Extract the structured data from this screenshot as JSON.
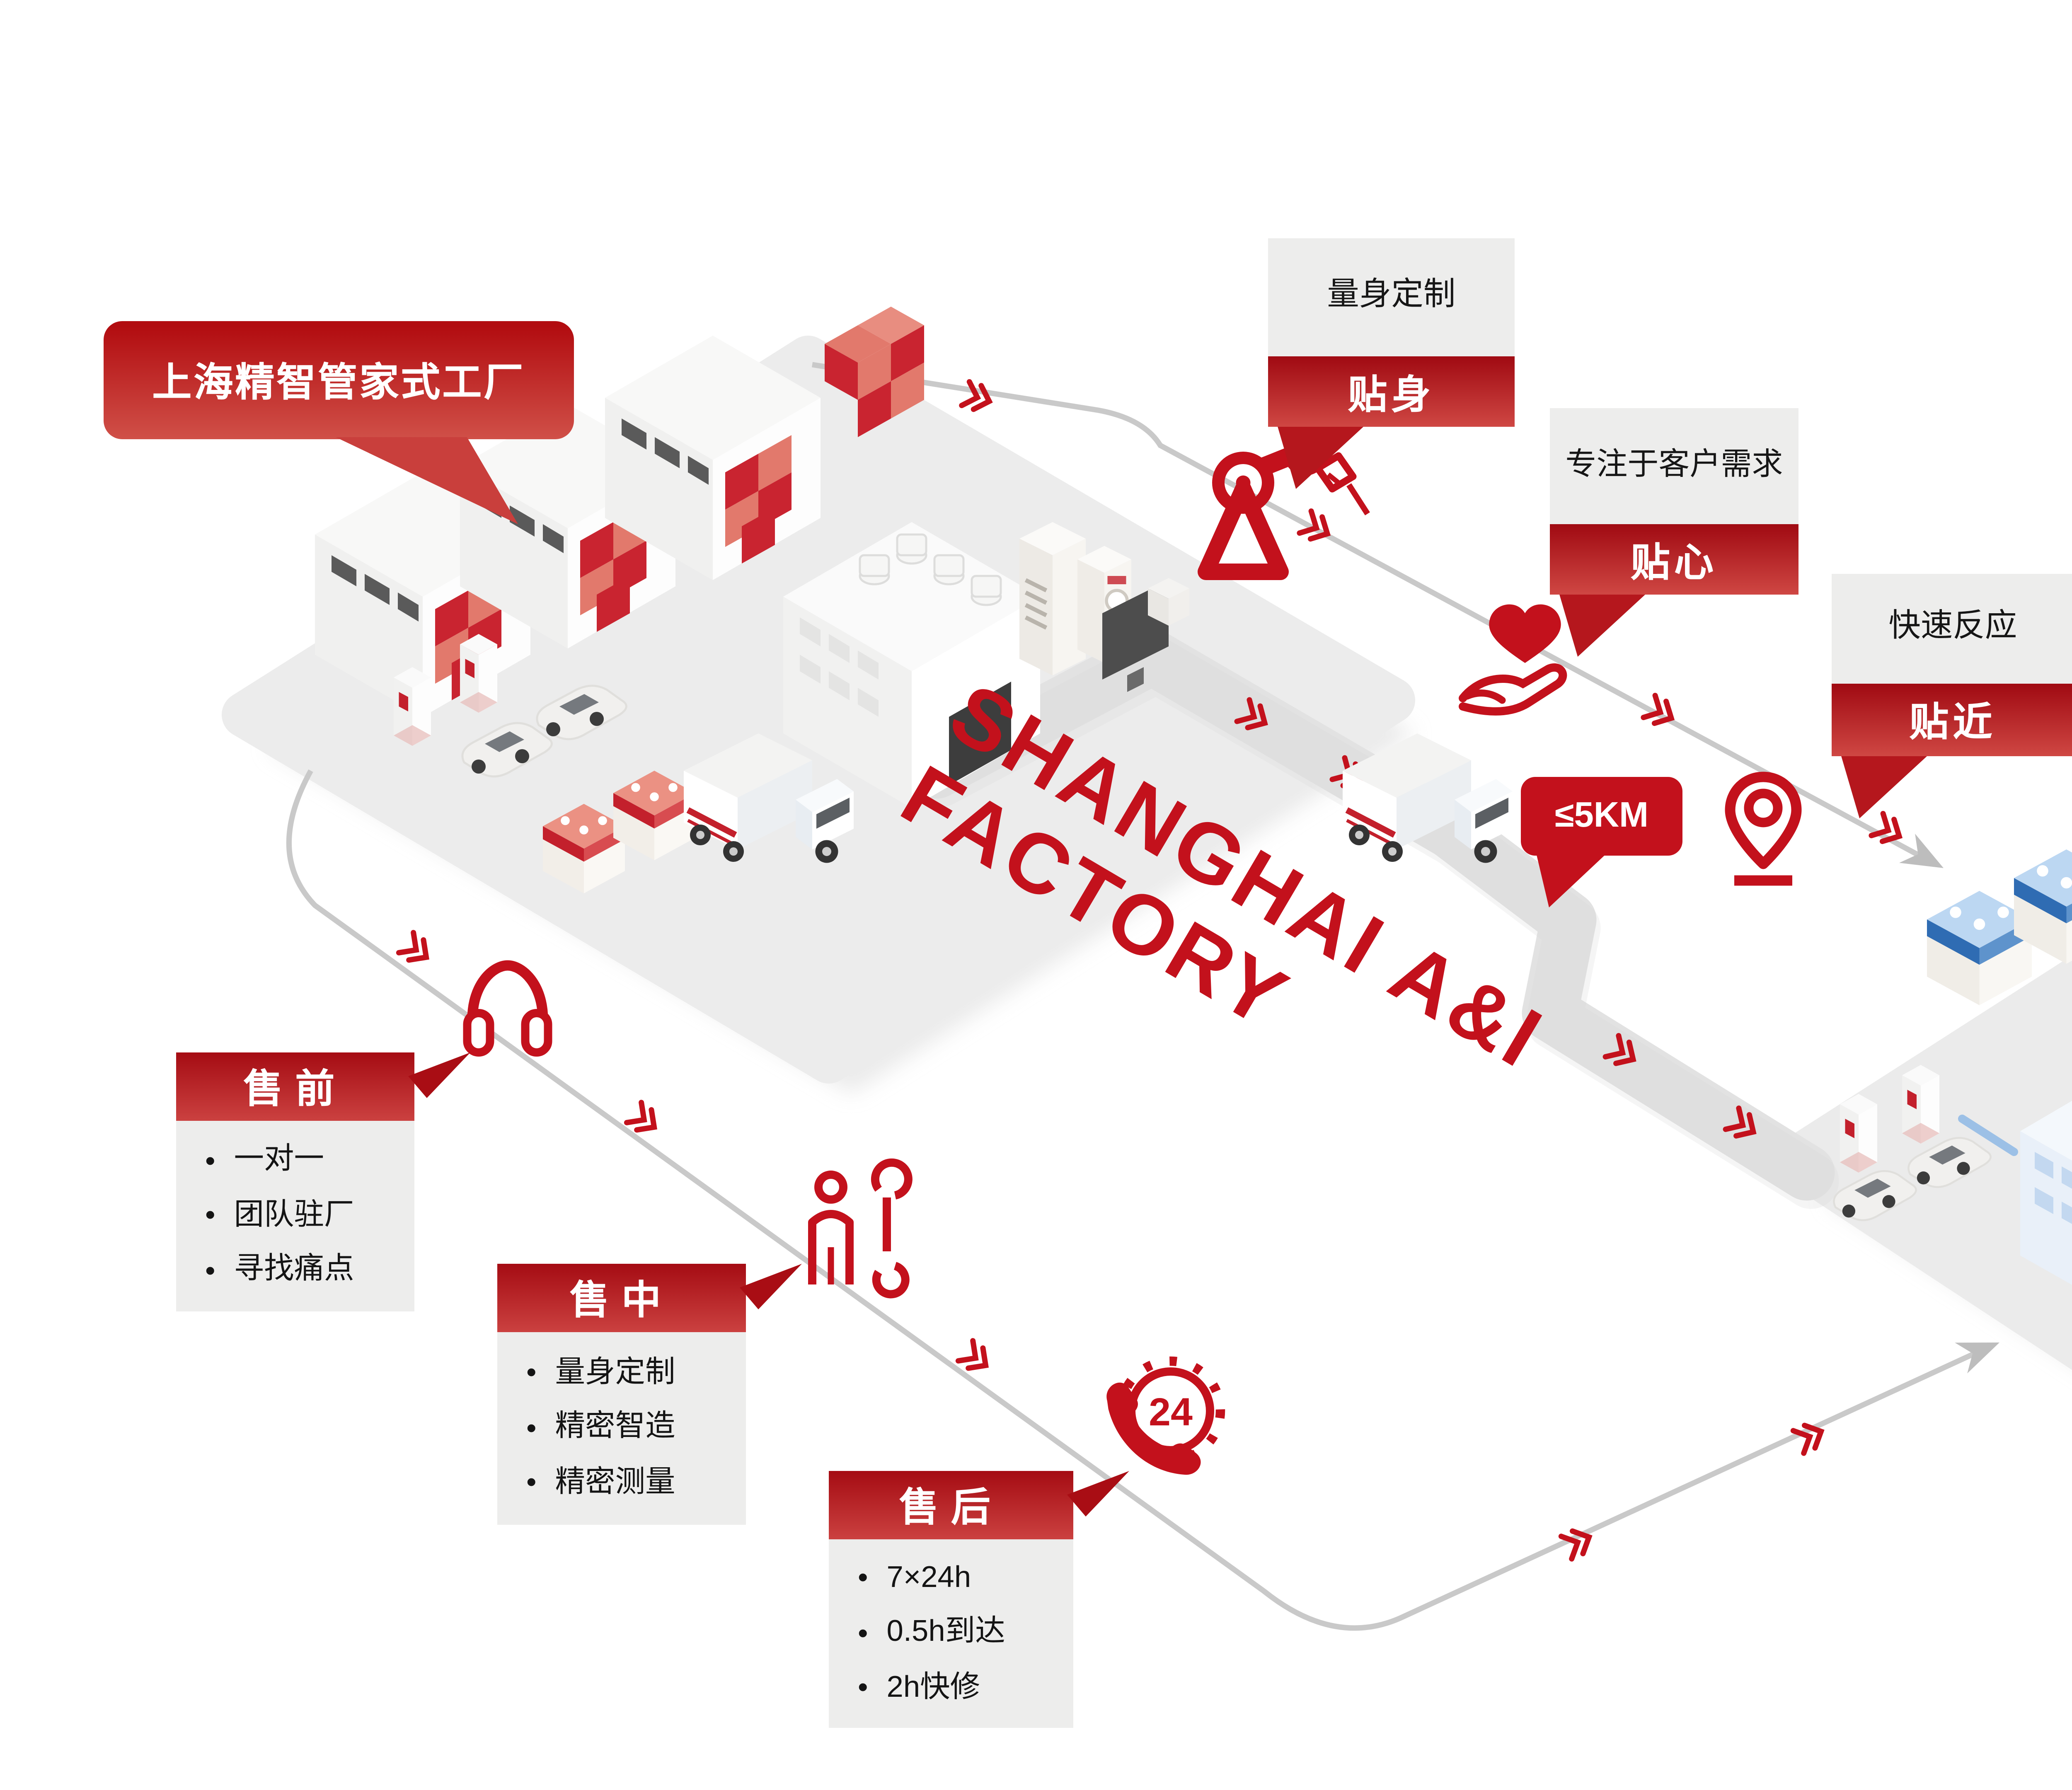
{
  "factory_bubble": {
    "label": "上海精智管家式工厂"
  },
  "customer_bubble": {
    "label": "客户"
  },
  "watermark": {
    "line1": "SHANGHAI A&I",
    "line2": "FACTORY"
  },
  "distance_badge": {
    "label": "≤5KM"
  },
  "feature_labels": [
    {
      "title": "量身定制",
      "tag": "贴身"
    },
    {
      "title": "专注于客户需求",
      "tag": "贴心"
    },
    {
      "title": "快速反应",
      "tag": "贴近"
    }
  ],
  "service_stages": [
    {
      "title": "售前",
      "items": [
        "一对一",
        "团队驻厂",
        "寻找痛点"
      ]
    },
    {
      "title": "售中",
      "items": [
        "量身定制",
        "精密智造",
        "精密测量"
      ]
    },
    {
      "title": "售后",
      "items": [
        "7×24h",
        "0.5h到达",
        "2h快修"
      ]
    }
  ],
  "icons": {
    "phone24_label": "24",
    "names": [
      "robot-arm-icon",
      "heart-in-hand-icon",
      "location-pin-icon",
      "headphones-icon",
      "service-person-wrench-icon",
      "phone-24h-icon",
      "chevron-arrow-icon",
      "flow-arrowhead-icon"
    ]
  },
  "colors": {
    "primary_red": "#c3111c",
    "red_gradient_dark": "#a50c13",
    "red_gradient_light": "#cf4743",
    "blue_dark": "#145991",
    "blue": "#2e86c4",
    "city_blue": "#b7d0ec",
    "platform_gray": "#ececec",
    "label_gray": "#ededec"
  }
}
